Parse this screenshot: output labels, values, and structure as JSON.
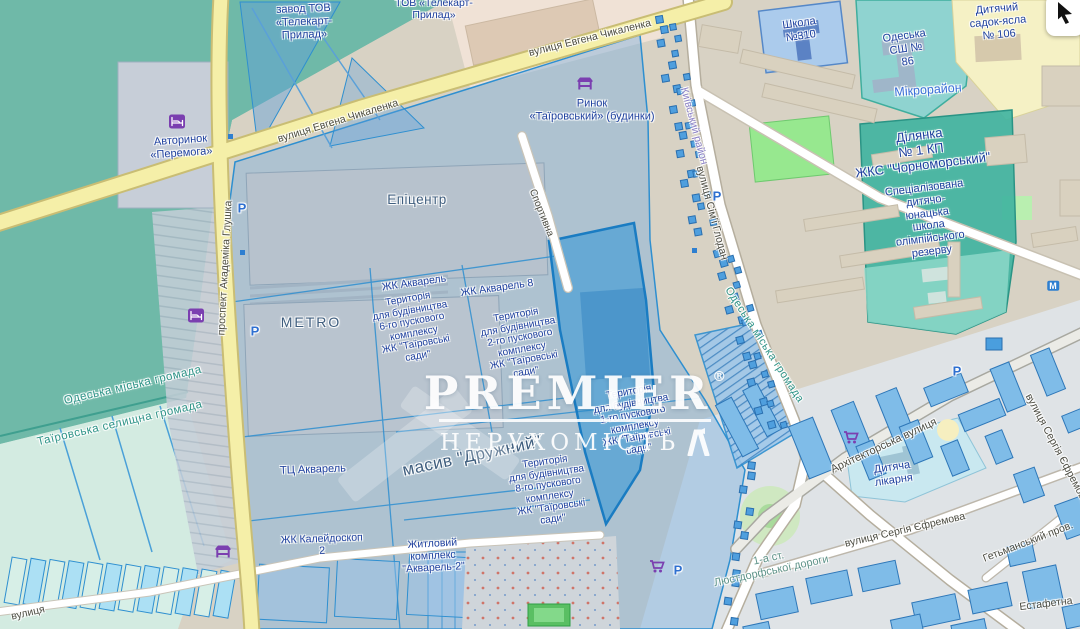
{
  "colors": {
    "overlay_blue": "#2e8fd0",
    "highlight": "#1a7cc2",
    "road_yellow": "#f5efa8",
    "garden_teal": "#6fb9a8",
    "poi_navy": "#1d3f9e",
    "area_teal": "#2f9488",
    "district_purple": "#8b80c7",
    "icon_purple": "#7b3fb0",
    "building_blue": "#7fbce8",
    "watermark": "#ffffff"
  },
  "watermark": {
    "brand": "PREMIER",
    "registered": "®",
    "subtitle": "НЕРУХОМІСТЬ"
  },
  "controls": {
    "cursor_button": {
      "icon": "cursor-arrow"
    }
  },
  "map": {
    "labels": [
      {
        "id": "street-chykalenka-upper",
        "text": "вулиця Евгена Чикаленка"
      },
      {
        "id": "street-chykalenka-lower",
        "text": "вулиця Евгена Чикаленка"
      },
      {
        "id": "street-hlushka",
        "text": "проспект Академіка Глушка"
      },
      {
        "id": "street-sportyvna",
        "text": "Спортивна"
      },
      {
        "id": "street-hlodan",
        "text": "вулиця Сім'ї Глодан"
      },
      {
        "id": "street-arkhitektorska",
        "text": "Архітекторська вулиця"
      },
      {
        "id": "street-yefremova",
        "text": "вулиця Сергія Єфремова"
      },
      {
        "id": "street-yefremova-2",
        "text": "вулиця Сергія Єфремова"
      },
      {
        "id": "street-hetmanskyi",
        "text": "Гетьманський пров."
      },
      {
        "id": "street-estafetna",
        "text": "Естафетна"
      },
      {
        "id": "street-bottom-left",
        "text": "вулиця"
      },
      {
        "id": "road-lyustdorf",
        "text": "1-а ст.\nЛюстдорфської дороги"
      },
      {
        "id": "hromada-odeska-1",
        "text": "Одеська міська громада"
      },
      {
        "id": "hromada-tairovska",
        "text": "Таїровська селищна громада"
      },
      {
        "id": "hromada-odeska-2",
        "text": "Одеська міська громада"
      },
      {
        "id": "district-kyivskyi",
        "text": "Київський район"
      },
      {
        "id": "poi-zavod",
        "text": "завод ТОВ\n«Телекарт-\nПрилад»"
      },
      {
        "id": "poi-tov",
        "text": "ТОВ «Телекарт-\nПрилад»"
      },
      {
        "id": "poi-avtorynok",
        "text": "Авторинок\n«Перемога»"
      },
      {
        "id": "poi-rynok",
        "text": "Ринок\n«Таїровський» (будинки)"
      },
      {
        "id": "poi-epitsentr",
        "text": "Епіцентр"
      },
      {
        "id": "poi-metro",
        "text": "METRO"
      },
      {
        "id": "poi-zhk-akvarel-1",
        "text": "ЖК Акварель"
      },
      {
        "id": "poi-zhk-akvarel-2",
        "text": "ЖК Акварель 8"
      },
      {
        "id": "poi-terytoria-6",
        "text": "Територія\nдля будівництва\n6-го пускового\nкомплексу\nЖК \"Таїровські\nсади\""
      },
      {
        "id": "poi-terytoria-2",
        "text": "Територія\nдля будівництва\n2-го пускового\nкомплексу\nЖК \"Таїровські\nсади\""
      },
      {
        "id": "poi-terytoria-1",
        "text": "Територія\nдля будівництва\n1-го пускового\nкомплексу\nЖК \"Таїровські\nсади\""
      },
      {
        "id": "poi-terytoria-8",
        "text": "Територія\nдля будівництва\n8-го пускового\nкомплексу\nЖК \"Таїровські\nсади\""
      },
      {
        "id": "poi-masyv-druzhnyi",
        "text": "масив \"Дружний\""
      },
      {
        "id": "poi-tts-akvarel",
        "text": "ТЦ Акварель"
      },
      {
        "id": "poi-kaleidoskop",
        "text": "ЖК Калейдоскоп\n2"
      },
      {
        "id": "poi-akvarel-2",
        "text": "Житловий\nкомплекс\n\"Акварель-2\""
      },
      {
        "id": "poi-shkola-310",
        "text": "Школа\n№310"
      },
      {
        "id": "poi-ssh-86",
        "text": "Одеська\nСШ №\n86"
      },
      {
        "id": "poi-sadok-106",
        "text": "Дитячий\nсадок-ясла\n№ 106"
      },
      {
        "id": "poi-mikroraion",
        "text": "Мікрорайон"
      },
      {
        "id": "poi-dilyanka",
        "text": "Ділянка\n№ 1 КП\nЖКС \"Чорноморський\""
      },
      {
        "id": "poi-spets-shkola",
        "text": "Спеціалізована\nдитячо-\nюнацька\nшкола\nолімпійського\nрезерву"
      },
      {
        "id": "poi-likarnya",
        "text": "Дитяча\nлікарня"
      },
      {
        "id": "parking-1",
        "text": "P"
      },
      {
        "id": "parking-2",
        "text": "P"
      },
      {
        "id": "parking-3",
        "text": "P"
      },
      {
        "id": "parking-4",
        "text": "P"
      },
      {
        "id": "parking-5",
        "text": "P"
      },
      {
        "id": "metro-marker",
        "text": "М"
      }
    ],
    "icons": [
      {
        "id": "hotel-icon-1",
        "glyph": "bed"
      },
      {
        "id": "hotel-icon-2",
        "glyph": "bed"
      },
      {
        "id": "market-icon-1",
        "glyph": "stall"
      },
      {
        "id": "market-icon-2",
        "glyph": "stall"
      },
      {
        "id": "cart-icon-1",
        "glyph": "cart"
      },
      {
        "id": "cart-icon-2",
        "glyph": "cart"
      }
    ]
  }
}
